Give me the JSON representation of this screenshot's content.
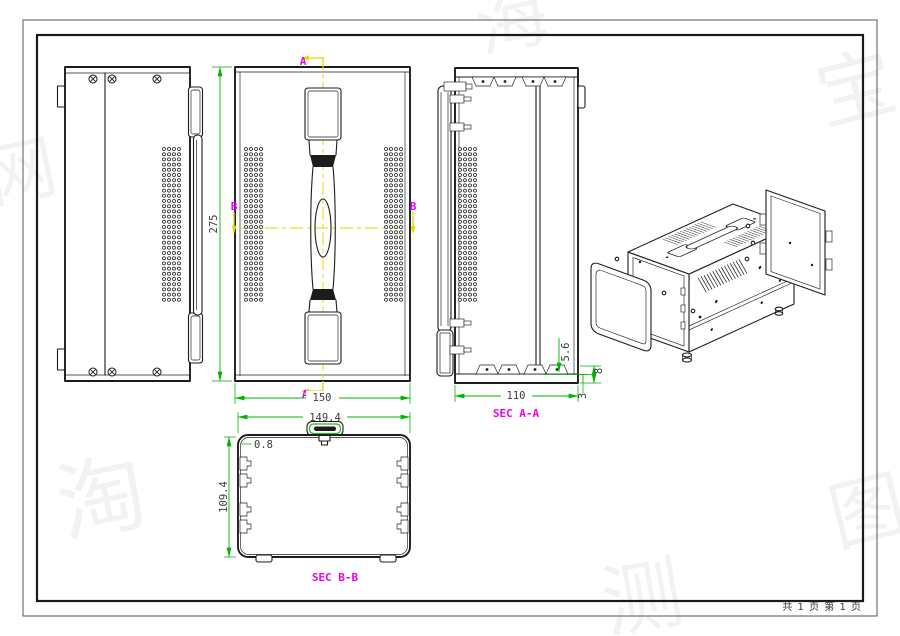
{
  "colors": {
    "line": "#1c1c1c",
    "border": "#1a1a1a",
    "dim": "#00b400",
    "dim-text": "#3c3c3c",
    "magenta": "#ee00ee",
    "cut": "#e3d800",
    "hatch": "#cfc52c",
    "cap-fill": "#ece73f",
    "cap-green": "#28b428"
  },
  "page": {
    "footer": "共 1 页  第 1 页"
  },
  "labels": {
    "section_a": "A",
    "section_b": "B",
    "sec_aa_title": "SEC A-A",
    "sec_bb_title": "SEC B-B"
  },
  "dims": {
    "front_height": "275",
    "front_width": "150",
    "secaa_width": "110",
    "secaa_inset": "5.6",
    "secaa_foot": "8",
    "secaa_bottom": "3",
    "secbb_width": "149.4",
    "secbb_height": "109.4",
    "secbb_wall": "0.8"
  },
  "watermark": {
    "glyphs": [
      {
        "char": "海"
      },
      {
        "char": "宝"
      },
      {
        "char": "淘"
      },
      {
        "char": "测"
      },
      {
        "char": "图"
      },
      {
        "char": "样"
      },
      {
        "char": "网"
      }
    ]
  }
}
